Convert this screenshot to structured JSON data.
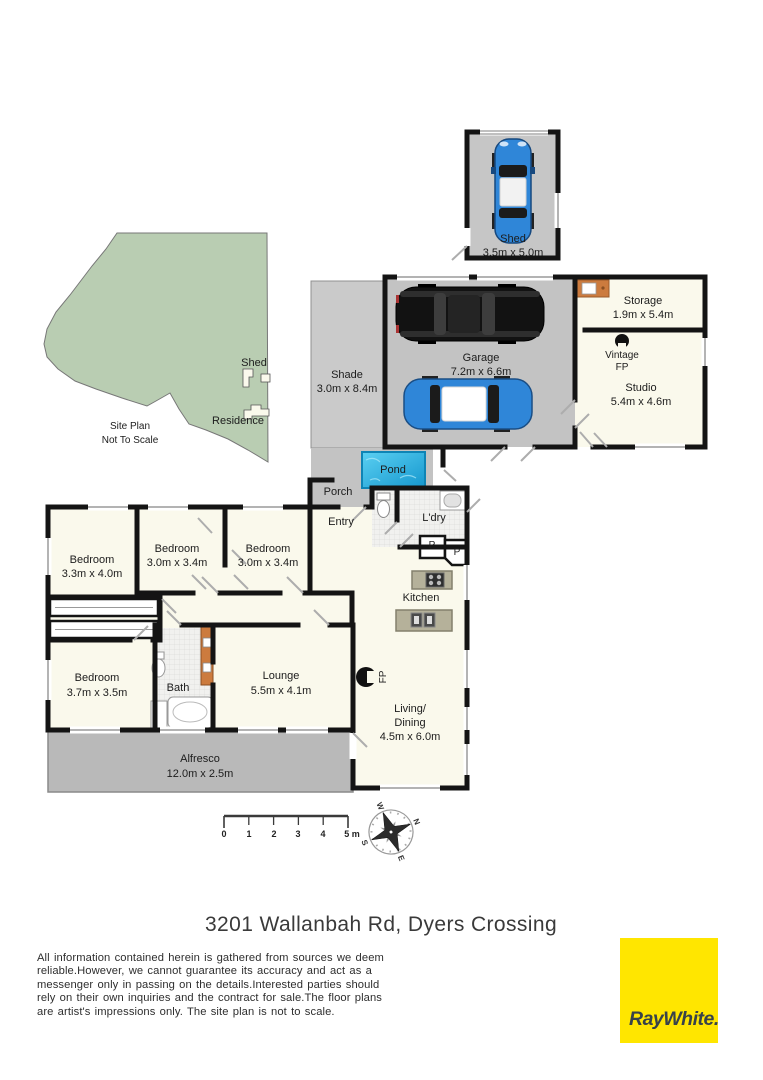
{
  "site_plan": {
    "shed_label": "Shed",
    "residence_label": "Residence",
    "note_line1": "Site Plan",
    "note_line2": "Not To Scale"
  },
  "buildings": {
    "shed": {
      "name": "Shed",
      "dims": "3.5m x 5.0m"
    },
    "garage": {
      "name": "Garage",
      "dims": "7.2m x 6.6m"
    },
    "storage": {
      "name": "Storage",
      "dims": "1.9m x 5.4m"
    },
    "studio": {
      "name": "Studio",
      "dims": "5.4m x 4.6m"
    },
    "vintage_fp": {
      "line1": "Vintage",
      "line2": "FP"
    },
    "shade": {
      "name": "Shade",
      "dims": "3.0m x 8.4m"
    }
  },
  "rooms": {
    "porch": "Porch",
    "entry": "Entry",
    "pond": "Pond",
    "laundry": "L'dry",
    "pantry": "P",
    "kitchen": "Kitchen",
    "bath": "Bath",
    "fireplace": "FP",
    "bedroom1": {
      "name": "Bedroom",
      "dims": "3.3m x 4.0m"
    },
    "bedroom2": {
      "name": "Bedroom",
      "dims": "3.0m x 3.4m"
    },
    "bedroom3": {
      "name": "Bedroom",
      "dims": "3.0m x 3.4m"
    },
    "bedroom4": {
      "name": "Bedroom",
      "dims": "3.7m x 3.5m"
    },
    "lounge": {
      "name": "Lounge",
      "dims": "5.5m x 4.1m"
    },
    "living": {
      "line1": "Living/",
      "line2": "Dining",
      "dims": "4.5m x 6.0m"
    },
    "alfresco": {
      "name": "Alfresco",
      "dims": "12.0m x 2.5m"
    }
  },
  "scale_bar": {
    "t0": "0",
    "t1": "1",
    "t2": "2",
    "t3": "3",
    "t4": "4",
    "t5": "5 m"
  },
  "compass": {
    "n": "N",
    "e": "E",
    "s": "S",
    "w": "W"
  },
  "footer": {
    "address": "3201 Wallanbah Rd, Dyers Crossing",
    "disclaimer_lines": [
      "All information contained herein is gathered from sources we deem",
      "reliable.However, we cannot guarantee its accuracy and act as a",
      "messenger only in passing on the details.Interested parties should",
      "rely on their own inquiries and the contract for sale.The floor plans",
      "are artist's impressions only. The site plan is not to scale."
    ],
    "brand": "RayWhite."
  },
  "colors": {
    "brand_yellow": "#FFE600",
    "brand_text": "#37424A",
    "floor_cream": "#FAF9EC",
    "concrete_gray": "#C3C3C3",
    "wall_black": "#141414",
    "pond_blue": "#2BB4E2",
    "site_green": "#B9CDB2",
    "cabinet_orange": "#CC7B3E"
  }
}
